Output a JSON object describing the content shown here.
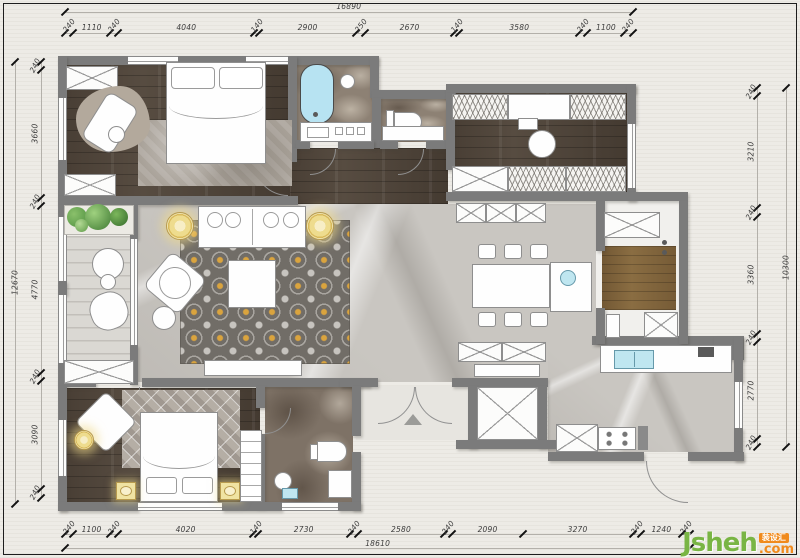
{
  "document": {
    "type": "interior-design-floor-plan"
  },
  "dimensions": {
    "top": {
      "total": "16890",
      "segments": [
        "240",
        "1110",
        "240",
        "4040",
        "140",
        "2900",
        "250",
        "2670",
        "140",
        "3580",
        "240",
        "1100",
        "240"
      ]
    },
    "bottom": {
      "total": "18610",
      "segments": [
        "240",
        "1100",
        "240",
        "4020",
        "140",
        "2730",
        "240",
        "2580",
        "240",
        "2090",
        "3270",
        "240",
        "1240",
        "240"
      ]
    },
    "left": {
      "total": "12670",
      "segments": [
        "240",
        "3660",
        "240",
        "4770",
        "240",
        "3090",
        "240"
      ]
    },
    "right": {
      "total": "10300",
      "segments": [
        "240",
        "3210",
        "240",
        "3360",
        "240",
        "2770",
        "240"
      ]
    }
  },
  "watermark": {
    "brand": "Jsheh",
    "tld": ".com",
    "badge": "装设汇",
    "brand_color": "#79b544",
    "accent_color": "#f08a1c"
  },
  "colors": {
    "paper": "#edebe6",
    "wall": "#7b7b7b",
    "dark_wood_floor": "#574c41",
    "marble_floor": "#c9c6c1",
    "bath_marble": "#8d8174",
    "pantry_wood": "#8a6d42",
    "accent_yellow": "#eedc8e",
    "tub_blue": "#b7e3f2",
    "plant_green": "#6fae53",
    "rug_accent_gold": "#dfa63c"
  }
}
